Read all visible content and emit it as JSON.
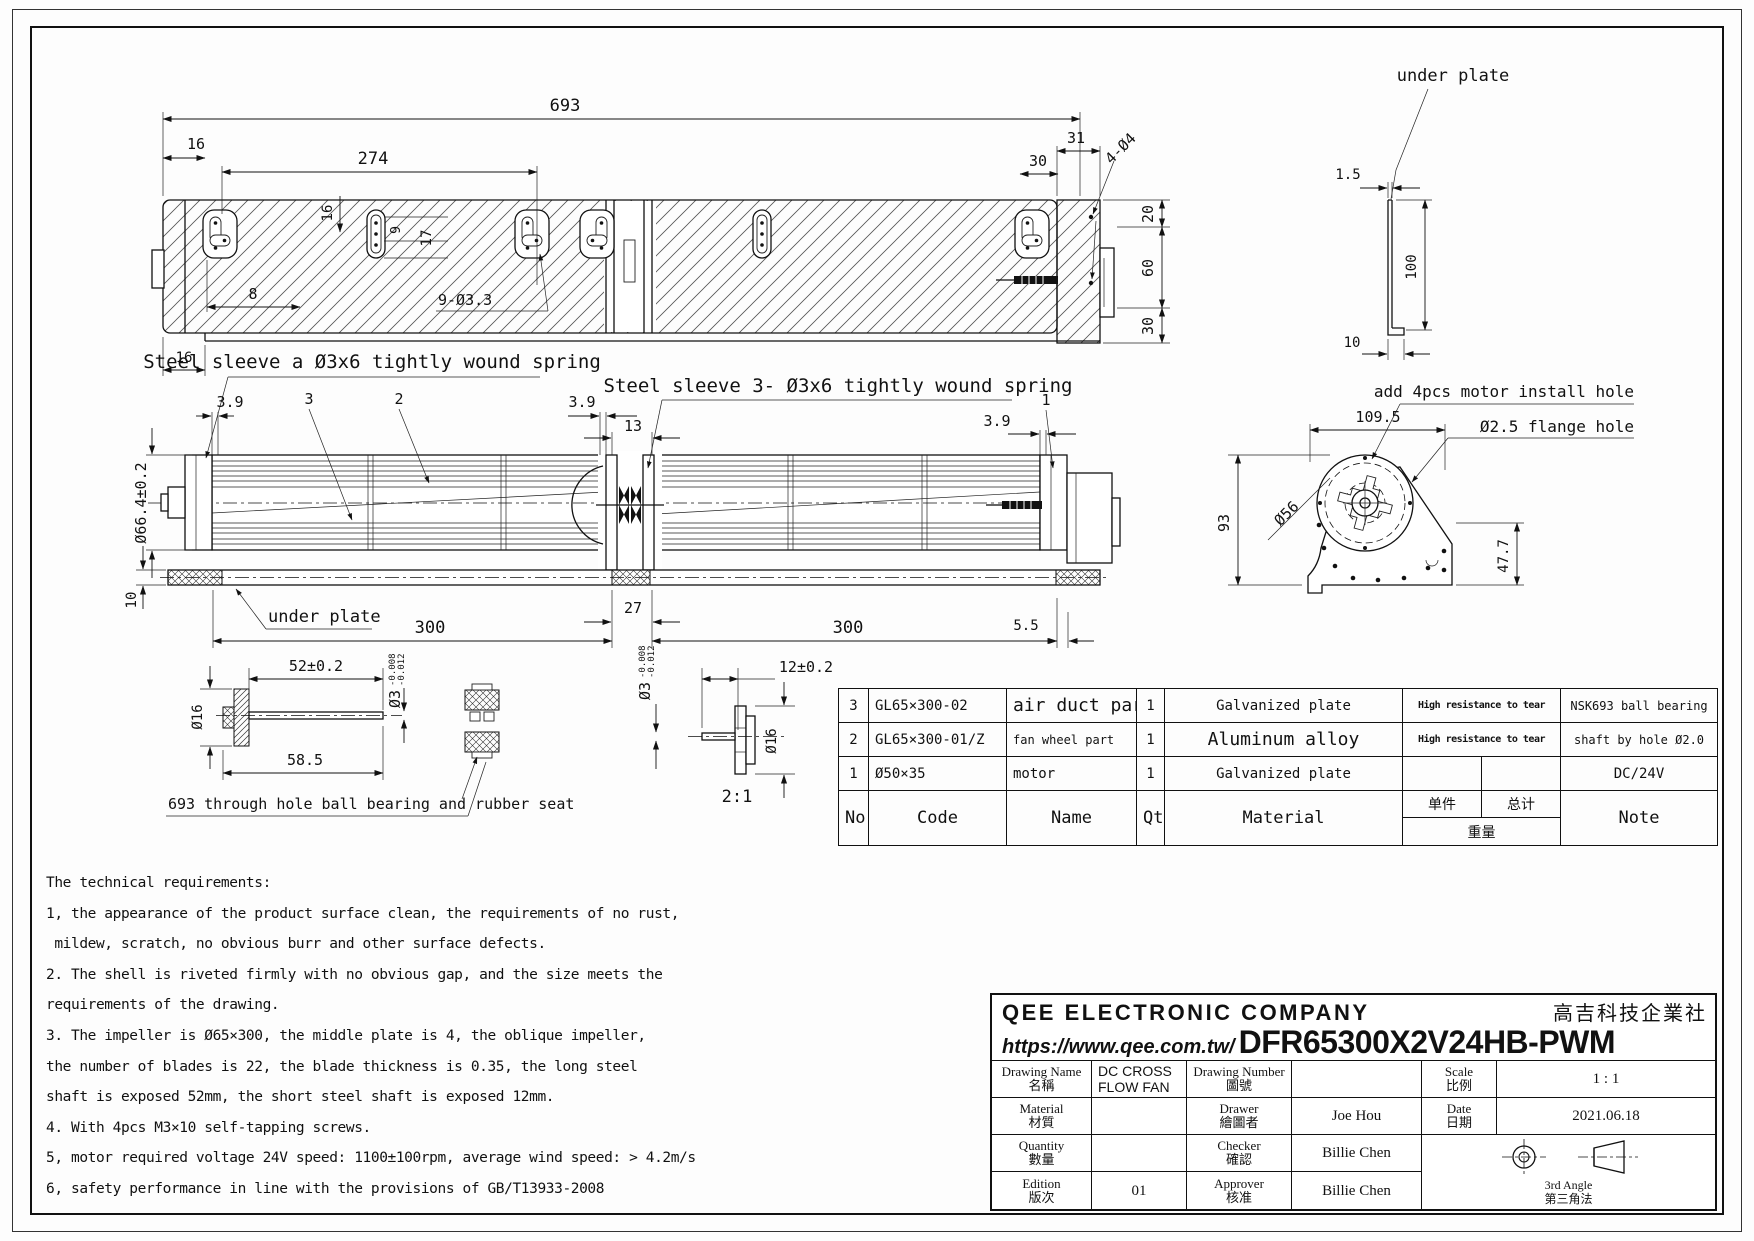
{
  "drawing": {
    "dims": {
      "d693": "693",
      "d16": "16",
      "d274": "274",
      "d31": "31",
      "d30": "30",
      "d20": "20",
      "d60": "60",
      "d9": "9",
      "d17": "17",
      "d8": "8",
      "holes_933": "9-Ø3.3",
      "holes_404": "4-Ø4",
      "d3_9": "3.9",
      "c3": "3",
      "c2": "2",
      "c1": "1",
      "d13": "13",
      "d27": "27",
      "d300": "300",
      "d5_5": "5.5",
      "d10": "10",
      "d66": "Ø66.4±0.2",
      "d1_5": "1.5",
      "d100": "100",
      "d109_5": "109.5",
      "d93": "93",
      "d56": "Ø56",
      "d47_7": "47.7",
      "d52": "52±0.2",
      "d58_5": "58.5",
      "d16dia": "Ø16",
      "d12": "12±0.2",
      "d3dia": "Ø3",
      "tol_up": "-0.008",
      "tol_dn": "-0.012",
      "scale_detail": "2:1"
    },
    "labels": {
      "under_plate": "under plate",
      "sleeve_a": "Steel sleeve a Ø3x6 tightly wound spring",
      "sleeve_3": "Steel sleeve 3- Ø3x6 tightly wound spring",
      "motor_install": "add 4pcs motor install hole",
      "flange_hole": "Ø2.5 flange hole",
      "bearing_note": "693 through hole ball bearing and rubber seat"
    }
  },
  "parts_table": {
    "headers": {
      "no": "No",
      "code": "Code",
      "name": "Name",
      "qty": "Qty",
      "material": "Material",
      "unit": "单件",
      "total": "总计",
      "weight": "重量",
      "note": "Note"
    },
    "rows": [
      {
        "no": "3",
        "code": "GL65×300-02",
        "name": "air duct part",
        "qty": "1",
        "material": "Galvanized plate",
        "weight_note": "High resistance to tear",
        "note": "NSK693 ball bearing"
      },
      {
        "no": "2",
        "code": "GL65×300-01/Z",
        "name": "fan wheel part",
        "qty": "1",
        "material": "Aluminum alloy",
        "weight_note": "High resistance to tear",
        "note": "shaft by hole Ø2.0"
      },
      {
        "no": "1",
        "code": "Ø50×35",
        "name": "motor",
        "qty": "1",
        "material": "Galvanized plate",
        "weight_note": "",
        "note": "DC/24V"
      }
    ]
  },
  "tech": {
    "title": "The technical requirements:",
    "lines": [
      "1, the appearance of the product surface clean, the requirements of no rust,",
      " mildew, scratch, no obvious burr and other surface defects.",
      "2. The shell is riveted firmly with no obvious gap, and the size meets the",
      "requirements of the drawing.",
      "3. The impeller is Ø65×300, the middle plate is 4, the oblique impeller,",
      "the number of blades is 22, the blade thickness is 0.35, the long steel",
      "shaft is exposed 52mm, the short steel shaft is exposed 12mm.",
      "4. With 4pcs M3×10 self-tapping screws.",
      "5, motor required voltage 24V speed: 1100±100rpm, average wind speed: > 4.2m/s",
      "6, safety performance in line with the provisions of GB/T13933-2008"
    ]
  },
  "title_block": {
    "company": "QEE ELECTRONIC COMPANY",
    "company_cn": "高吉科技企業社",
    "url": "https://www.qee.com.tw/",
    "part_number": "DFR65300X2V24HB-PWM",
    "drawing_name_label": "Drawing Name",
    "drawing_name_cn": "名稱",
    "drawing_name_value": "DC CROSS FLOW FAN",
    "drawing_number_label": "Drawing Number",
    "drawing_number_cn": "圖號",
    "scale_label": "Scale",
    "scale_cn": "比例",
    "scale_value": "1 : 1",
    "material_label": "Material",
    "material_cn": "材質",
    "drawer_label": "Drawer",
    "drawer_cn": "繪圖者",
    "drawer_value": "Joe Hou",
    "date_label": "Date",
    "date_cn": "日期",
    "date_value": "2021.06.18",
    "quantity_label": "Quantity",
    "quantity_cn": "數量",
    "quantity_value": "01",
    "checker_label": "Checker",
    "checker_cn": "確認",
    "checker_value": "Billie Chen",
    "edition_label": "Edition",
    "edition_cn": "版次",
    "approver_label": "Approver",
    "approver_cn": "核准",
    "approver_value": "Billie Chen",
    "angle_label": "3rd Angle",
    "angle_cn": "第三角法"
  }
}
